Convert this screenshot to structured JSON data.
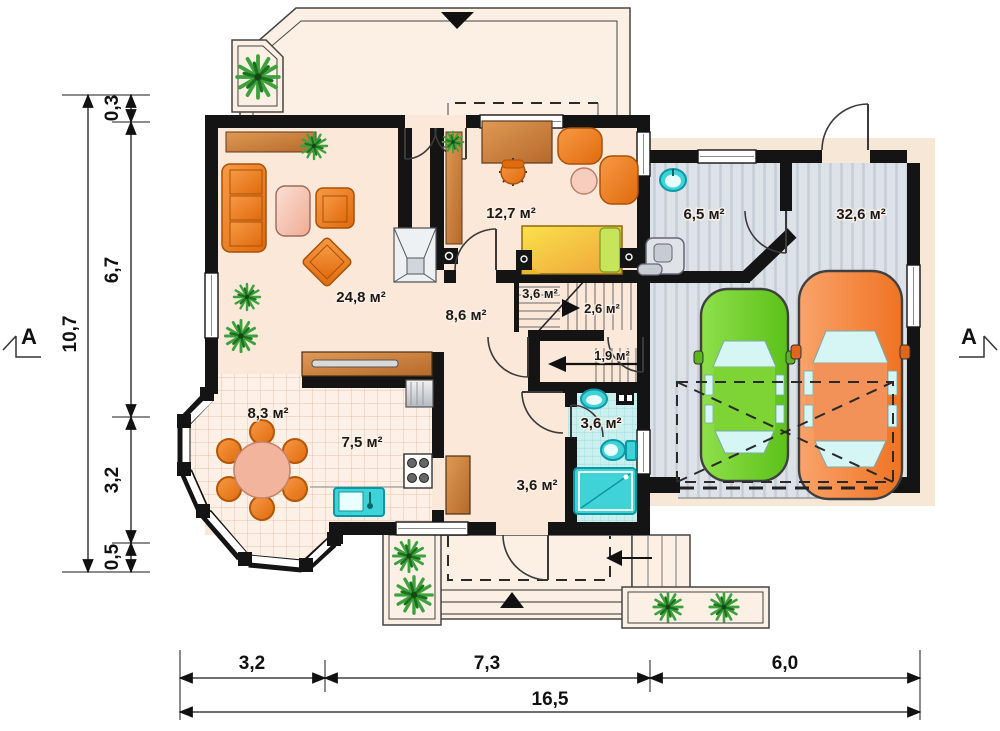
{
  "rooms": {
    "living": {
      "label": "24,8 м²"
    },
    "study": {
      "label": "12,7 м²"
    },
    "hall": {
      "label": "8,6 м²"
    },
    "stairs_upper": {
      "label": "3,6 м²"
    },
    "stairs_flight": {
      "label": "2,6 м²"
    },
    "stairs_lower": {
      "label": "1,9 м²"
    },
    "utility": {
      "label": "6,5 м²"
    },
    "garage": {
      "label": "32,6 м²"
    },
    "dining": {
      "label": "8,3 м²"
    },
    "kitchen": {
      "label": "7,5 м²"
    },
    "hallway": {
      "label": "3,6 м²"
    },
    "bathroom": {
      "label": "3,6 м²"
    }
  },
  "dimensions": {
    "left": {
      "total": "10,7",
      "segments": [
        "0,3",
        "6,7",
        "3,2",
        "0,5"
      ]
    },
    "bottom": {
      "total": "16,5",
      "segments": [
        "3,2",
        "7,3",
        "6,0"
      ]
    }
  },
  "section_markers": {
    "left": "A",
    "right": "A"
  },
  "icons": {
    "entrance-arrow-icon": "▼",
    "porch-arrow-icon": "▲",
    "exit-arrow-icon": "◀",
    "stair-direction-arrow-icon": "►",
    "plant-icon": "radial-leaves"
  },
  "colors": {
    "wall": "#141414",
    "floor_cream": "#fbe8d9",
    "garage_floor": "#dde1e8",
    "bathroom_tile": "#c9f0ef",
    "furniture_orange": "#ee7d1f",
    "fixture_teal": "#3fd3d8",
    "car_green": "#6fcc2e",
    "car_orange": "#f4813b",
    "plant_green": "#3da23d"
  }
}
